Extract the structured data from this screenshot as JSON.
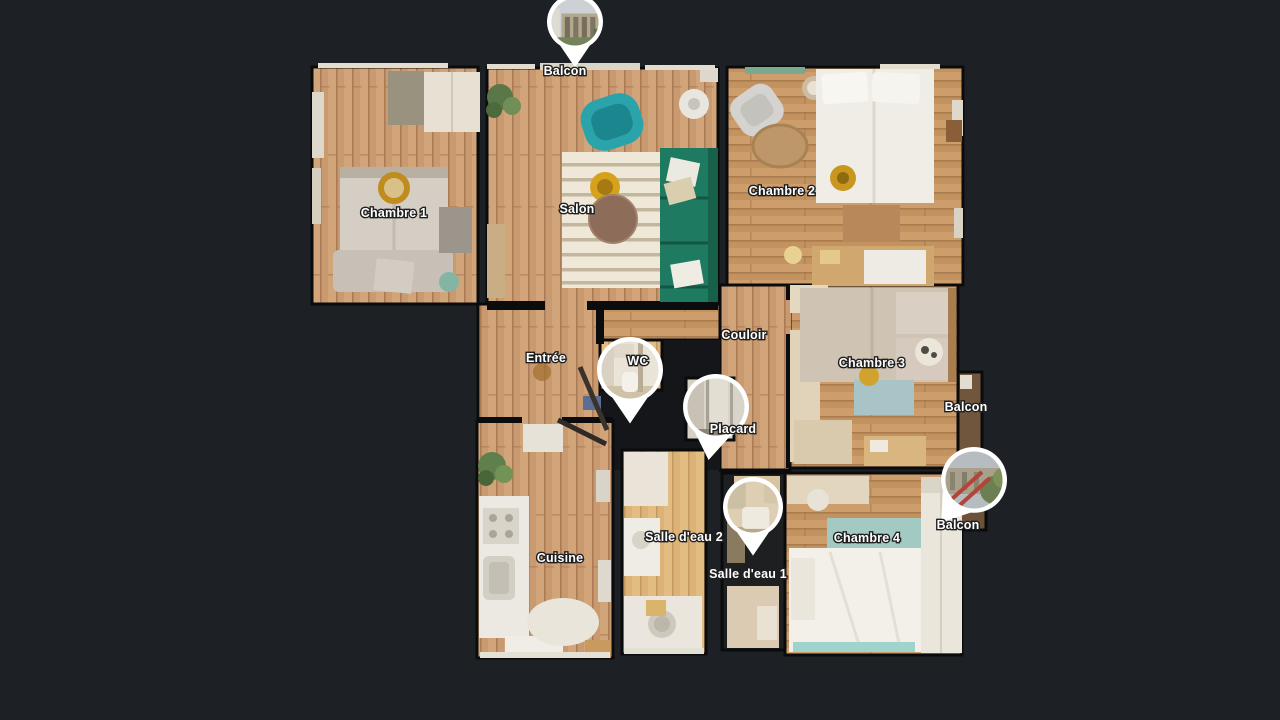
{
  "view": {
    "name": "dollhouse-floorplan-3d-tour"
  },
  "palette": {
    "bg": "#1d2125",
    "wall": "#0b0c0d",
    "label-fill": "#ffffff",
    "label-stroke": "#1f1f1f",
    "marker-border": "#ffffff",
    "wood": "#c99a6f",
    "wood-light": "#dcb277",
    "accent-teal-armchair": "#2aa3ab",
    "accent-green-sofa": "#1e7a60",
    "accent-gold": "#c9971f",
    "accent-blue-rug": "#a9c4c7"
  },
  "floorplan": {
    "labels": [
      {
        "name": "balcon-top",
        "text": "Balcon",
        "x": 565,
        "y": 75
      },
      {
        "name": "chambre-1",
        "text": "Chambre 1",
        "x": 394,
        "y": 217
      },
      {
        "name": "salon",
        "text": "Salon",
        "x": 577,
        "y": 213
      },
      {
        "name": "chambre-2",
        "text": "Chambre 2",
        "x": 782,
        "y": 195
      },
      {
        "name": "couloir",
        "text": "Couloir",
        "x": 744,
        "y": 339
      },
      {
        "name": "entree",
        "text": "Entrée",
        "x": 546,
        "y": 362
      },
      {
        "name": "wc",
        "text": "WC",
        "x": 638,
        "y": 365
      },
      {
        "name": "chambre-3",
        "text": "Chambre 3",
        "x": 872,
        "y": 367
      },
      {
        "name": "balcon-right",
        "text": "Balcon",
        "x": 966,
        "y": 411
      },
      {
        "name": "placard",
        "text": "Placard",
        "x": 733,
        "y": 433
      },
      {
        "name": "salle-deau-2",
        "text": "Salle d'eau 2",
        "x": 684,
        "y": 541
      },
      {
        "name": "cuisine",
        "text": "Cuisine",
        "x": 560,
        "y": 562
      },
      {
        "name": "salle-deau-1",
        "text": "Salle d'eau 1",
        "x": 748,
        "y": 578
      },
      {
        "name": "chambre-4",
        "text": "Chambre 4",
        "x": 867,
        "y": 542
      },
      {
        "name": "balcon-bottom",
        "text": "Balcon",
        "x": 958,
        "y": 529
      }
    ],
    "markers": [
      {
        "name": "pano-marker-balcon-top",
        "photo": "exterior-building",
        "cx": 575,
        "cy": 22,
        "r": 28,
        "rot": 0
      },
      {
        "name": "pano-marker-wc",
        "photo": "wc-interior",
        "cx": 630,
        "cy": 370,
        "r": 33,
        "rot": 0
      },
      {
        "name": "pano-marker-placard",
        "photo": "closet-interior",
        "cx": 716,
        "cy": 407,
        "r": 33,
        "rot": 8
      },
      {
        "name": "pano-marker-salle-deau-1",
        "photo": "bathroom-interior",
        "cx": 753,
        "cy": 507,
        "r": 30,
        "rot": 0
      },
      {
        "name": "pano-marker-balcon-right",
        "photo": "terrace-exterior",
        "cx": 974,
        "cy": 480,
        "r": 33,
        "rot": 38
      }
    ]
  }
}
